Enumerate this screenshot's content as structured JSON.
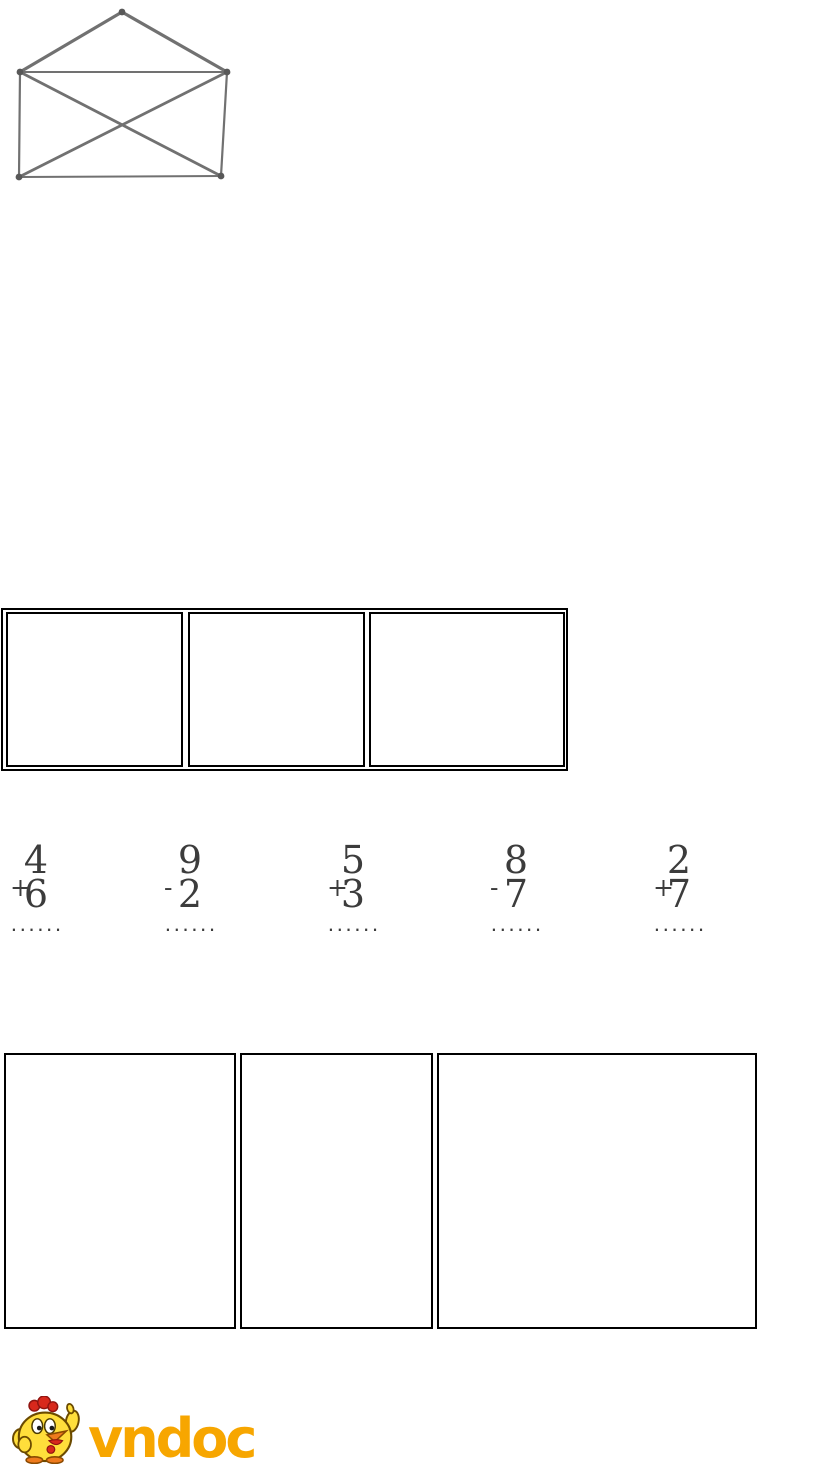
{
  "page": {
    "background": "#ffffff"
  },
  "figure": {
    "name": "envelope-line-figure",
    "description": "rectangle with crossed diagonals and a triangle roof (count-the-shapes exercise figure)",
    "stroke_color": "#717171",
    "dot_color": "#585858",
    "vertices": {
      "apex": [
        122,
        12
      ],
      "top_left": [
        20,
        72
      ],
      "top_right": [
        227,
        72
      ],
      "bottom_left": [
        19,
        177
      ],
      "bottom_right": [
        221,
        176
      ]
    },
    "edges": [
      [
        "apex",
        "top_left",
        3.2
      ],
      [
        "apex",
        "top_right",
        3.2
      ],
      [
        "top_left",
        "top_right",
        2.0
      ],
      [
        "top_left",
        "bottom_left",
        2.2
      ],
      [
        "top_right",
        "bottom_right",
        2.2
      ],
      [
        "bottom_left",
        "bottom_right",
        2.0
      ],
      [
        "top_left",
        "bottom_right",
        2.8
      ],
      [
        "top_right",
        "bottom_left",
        2.8
      ]
    ]
  },
  "middle_boxes": {
    "description": "row of three empty answer cells inside an outer frame",
    "border_color": "#000000",
    "count": 3
  },
  "problems": {
    "answer_placeholder": "......",
    "digit_color": "#3c3c3c",
    "rule_color": "#8f8f8f",
    "items": [
      {
        "operator": "+",
        "top": "4",
        "bottom": "6"
      },
      {
        "operator": "-",
        "top": "9",
        "bottom": "2"
      },
      {
        "operator": "+",
        "top": "5",
        "bottom": "3"
      },
      {
        "operator": "-",
        "top": "8",
        "bottom": "7"
      },
      {
        "operator": "+",
        "top": "2",
        "bottom": "7"
      }
    ]
  },
  "bottom_boxes": {
    "description": "row of three empty answer boxes",
    "border_color": "#000000",
    "count": 3
  },
  "logo": {
    "text": "vndoc",
    "text_color": "#F7A600",
    "mascot": "chicken-mascot",
    "mascot_colors": {
      "body": "#FFDE3B",
      "comb": "#D8281C",
      "beak": "#EE7A1D",
      "feet": "#EE7A1D",
      "outline": "#6b4a00"
    }
  }
}
